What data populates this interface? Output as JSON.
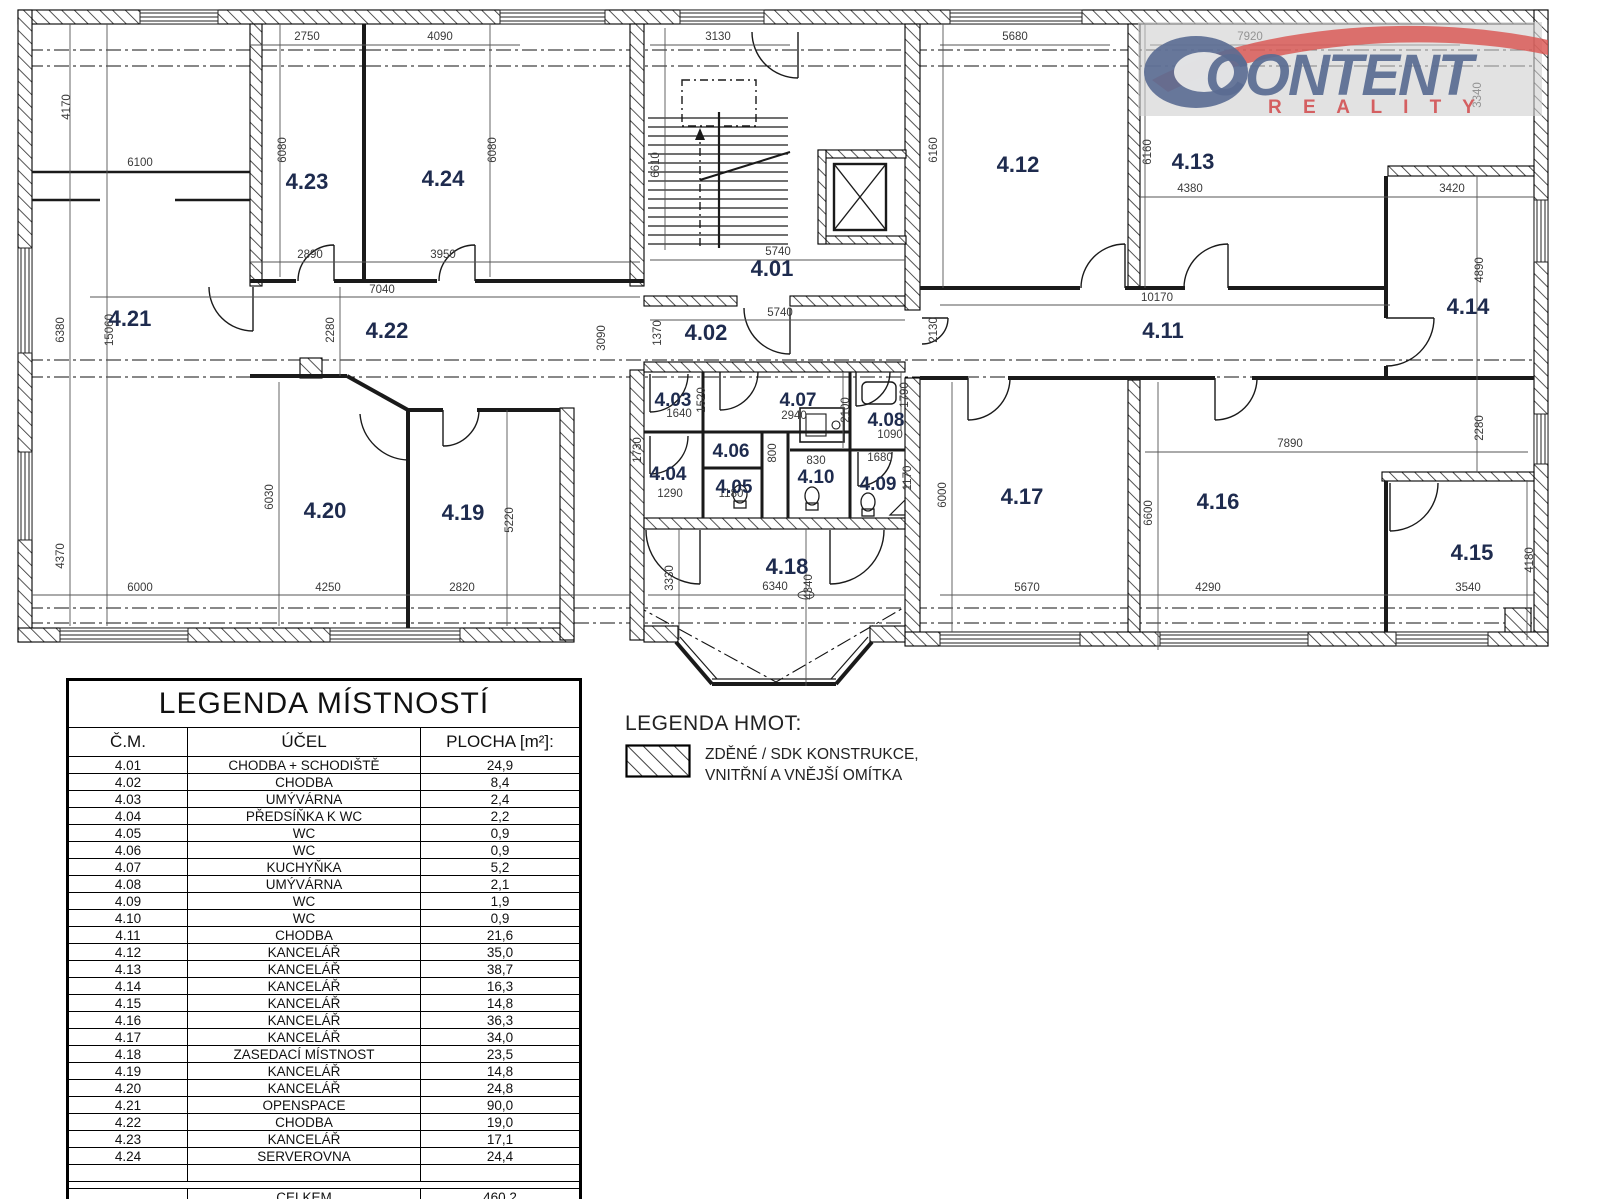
{
  "logo": {
    "brand": "CONTENT",
    "sub": "R E A L I T Y"
  },
  "plan": {
    "rooms": [
      "4.01",
      "4.02",
      "4.03",
      "4.04",
      "4.05",
      "4.06",
      "4.07",
      "4.08",
      "4.09",
      "4.10",
      "4.11",
      "4.12",
      "4.13",
      "4.14",
      "4.15",
      "4.16",
      "4.17",
      "4.18",
      "4.19",
      "4.20",
      "4.21",
      "4.22",
      "4.23",
      "4.24"
    ],
    "dims": [
      "4170",
      "6100",
      "2750",
      "4090",
      "3130",
      "5680",
      "7920",
      "3340",
      "6080",
      "6080",
      "6610",
      "6160",
      "6160",
      "4380",
      "3420",
      "2890",
      "3950",
      "5740",
      "7040",
      "10170",
      "5740",
      "1370",
      "2280",
      "3090",
      "2130",
      "4890",
      "15060",
      "6380",
      "1640",
      "1520",
      "2940",
      "2100",
      "1790",
      "1090",
      "1730",
      "800",
      "830",
      "1680",
      "1170",
      "1290",
      "1180",
      "6030",
      "5220",
      "6000",
      "6600",
      "2280",
      "7890",
      "4180",
      "4370",
      "6000",
      "4250",
      "2820",
      "3330",
      "6340",
      "4340",
      "5670",
      "4290",
      "3540"
    ]
  },
  "room_legend": {
    "title": "LEGENDA MÍSTNOSTÍ",
    "headers": {
      "cm": "Č.M.",
      "ucel": "ÚČEL",
      "plocha": "PLOCHA [m²]:"
    },
    "rows": [
      {
        "cm": "4.01",
        "ucel": "CHODBA + SCHODIŠTĚ",
        "plocha": "24,9"
      },
      {
        "cm": "4.02",
        "ucel": "CHODBA",
        "plocha": "8,4"
      },
      {
        "cm": "4.03",
        "ucel": "UMÝVÁRNA",
        "plocha": "2,4"
      },
      {
        "cm": "4.04",
        "ucel": "PŘEDSÍŇKA K WC",
        "plocha": "2,2"
      },
      {
        "cm": "4.05",
        "ucel": "WC",
        "plocha": "0,9"
      },
      {
        "cm": "4.06",
        "ucel": "WC",
        "plocha": "0,9"
      },
      {
        "cm": "4.07",
        "ucel": "KUCHYŇKA",
        "plocha": "5,2"
      },
      {
        "cm": "4.08",
        "ucel": "UMÝVÁRNA",
        "plocha": "2,1"
      },
      {
        "cm": "4.09",
        "ucel": "WC",
        "plocha": "1,9"
      },
      {
        "cm": "4.10",
        "ucel": "WC",
        "plocha": "0,9"
      },
      {
        "cm": "4.11",
        "ucel": "CHODBA",
        "plocha": "21,6"
      },
      {
        "cm": "4.12",
        "ucel": "KANCELÁŘ",
        "plocha": "35,0"
      },
      {
        "cm": "4.13",
        "ucel": "KANCELÁŘ",
        "plocha": "38,7"
      },
      {
        "cm": "4.14",
        "ucel": "KANCELÁŘ",
        "plocha": "16,3"
      },
      {
        "cm": "4.15",
        "ucel": "KANCELÁŘ",
        "plocha": "14,8"
      },
      {
        "cm": "4.16",
        "ucel": "KANCELÁŘ",
        "plocha": "36,3"
      },
      {
        "cm": "4.17",
        "ucel": "KANCELÁŘ",
        "plocha": "34,0"
      },
      {
        "cm": "4.18",
        "ucel": "ZASEDACÍ MÍSTNOST",
        "plocha": "23,5"
      },
      {
        "cm": "4.19",
        "ucel": "KANCELÁŘ",
        "plocha": "14,8"
      },
      {
        "cm": "4.20",
        "ucel": "KANCELÁŘ",
        "plocha": "24,8"
      },
      {
        "cm": "4.21",
        "ucel": "OPENSPACE",
        "plocha": "90,0"
      },
      {
        "cm": "4.22",
        "ucel": "CHODBA",
        "plocha": "19,0"
      },
      {
        "cm": "4.23",
        "ucel": "KANCELÁŘ",
        "plocha": "17,1"
      },
      {
        "cm": "4.24",
        "ucel": "SERVEROVNA",
        "plocha": "24,4"
      }
    ],
    "total": {
      "label": "CELKEM",
      "value": "460,2"
    }
  },
  "materials_legend": {
    "title": "LEGENDA HMOT:",
    "line1": "ZDĚNÉ / SDK KONSTRUKCE,",
    "line2": "VNITŘNÍ A VNĚJŠÍ OMÍTKA"
  },
  "colors": {
    "room_label": "#1e2b4e",
    "dim_text": "#3a3a3a",
    "logo_blue": "#5a6c92",
    "logo_red": "#d4595b"
  }
}
